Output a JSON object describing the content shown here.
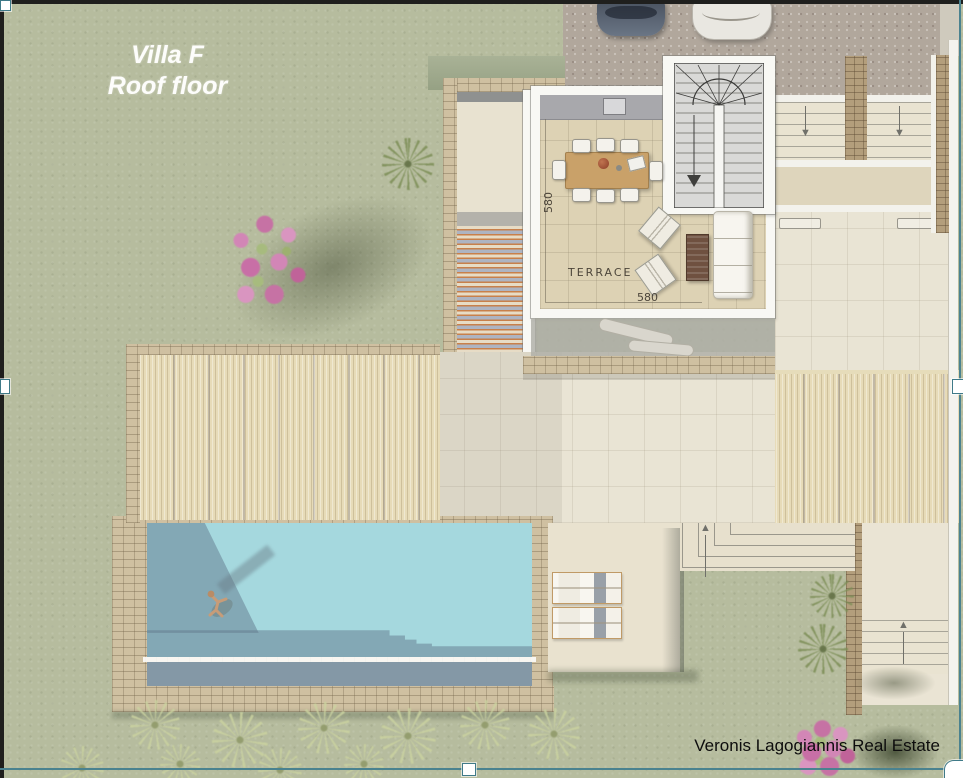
{
  "title": {
    "line1": "Villa F",
    "line2": "Roof floor"
  },
  "plan": {
    "terrace_label": "TERRACE",
    "dim_vertical": "580",
    "dim_horizontal": "580"
  },
  "watermark": "Veronis Lagogiannis Real Estate",
  "icons": {
    "down_arrow": "▼",
    "up_arrow": "▲"
  },
  "colors": {
    "grass": "#b6bc9e",
    "gravel": "#b1a79c",
    "pool_water": "#a5d8de",
    "pool_shadow": "#62788c",
    "tile_floor": "#ddd2b4",
    "patio": "#e9e4d4",
    "pergola_slats": "#e7dbb8",
    "stone": "#cfc0a1",
    "wall_white": "#f8f8f4",
    "counter_gray": "#a8a8ac",
    "table_wood": "#c9a169",
    "stripe_orange": "#c8804b",
    "stripe_blue": "#aeb4c2",
    "bougainvillea_pink": "#c86fa6",
    "title_text": "#ffffff",
    "watermark_text": "#0d0d0d",
    "selection_accent": "#4a828f"
  }
}
